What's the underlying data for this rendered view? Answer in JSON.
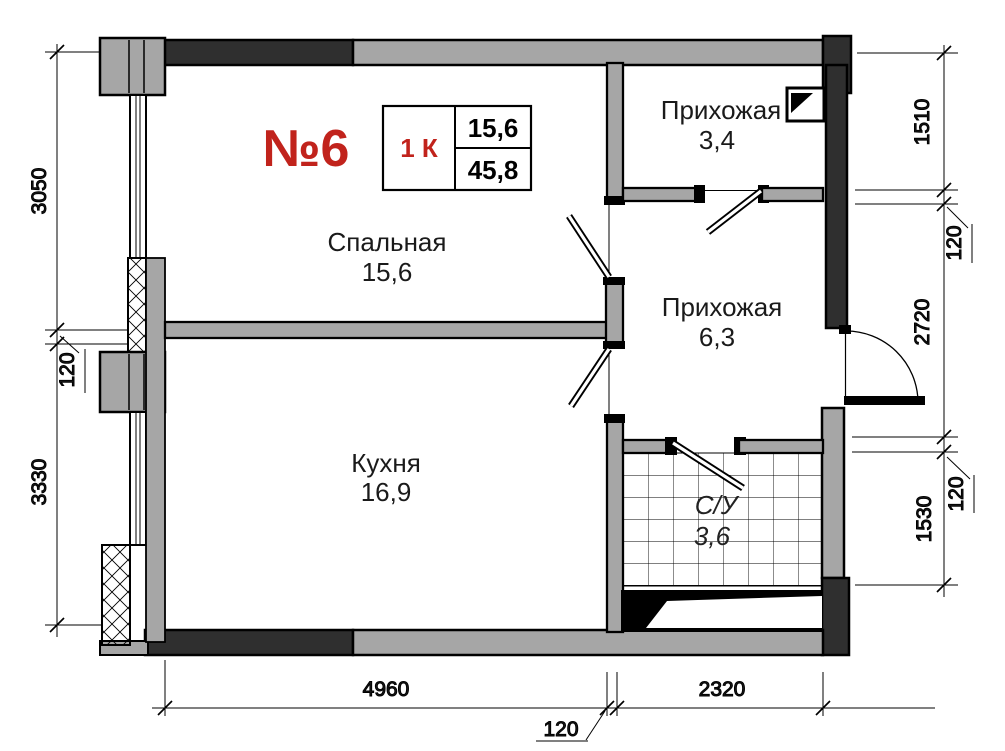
{
  "title": {
    "apartment_number": "№6"
  },
  "info_table": {
    "room_count": "1 К",
    "living_area": "15,6",
    "total_area": "45,8"
  },
  "rooms": {
    "bedroom": {
      "name": "Спальная",
      "area": "15,6"
    },
    "kitchen": {
      "name": "Кухня",
      "area": "16,9"
    },
    "hallway_small": {
      "name": "Прихожая",
      "area": "3,4"
    },
    "hallway": {
      "name": "Прихожая",
      "area": "6,3"
    },
    "bathroom": {
      "name": "С/У",
      "area": "3,6"
    }
  },
  "dimensions": {
    "left": {
      "top": "3050",
      "middle": "120",
      "bottom": "3330"
    },
    "right": {
      "r1": "1510",
      "r2": "120",
      "r3": "2720",
      "r4": "120",
      "r5": "1530"
    },
    "bottom": {
      "left": "4960",
      "middle": "120",
      "right": "2320"
    }
  },
  "colors": {
    "wall_dark": "#2f2f2f",
    "wall_gray": "#a6a6a6",
    "outline": "#000000",
    "accent_red": "#c1231c"
  }
}
